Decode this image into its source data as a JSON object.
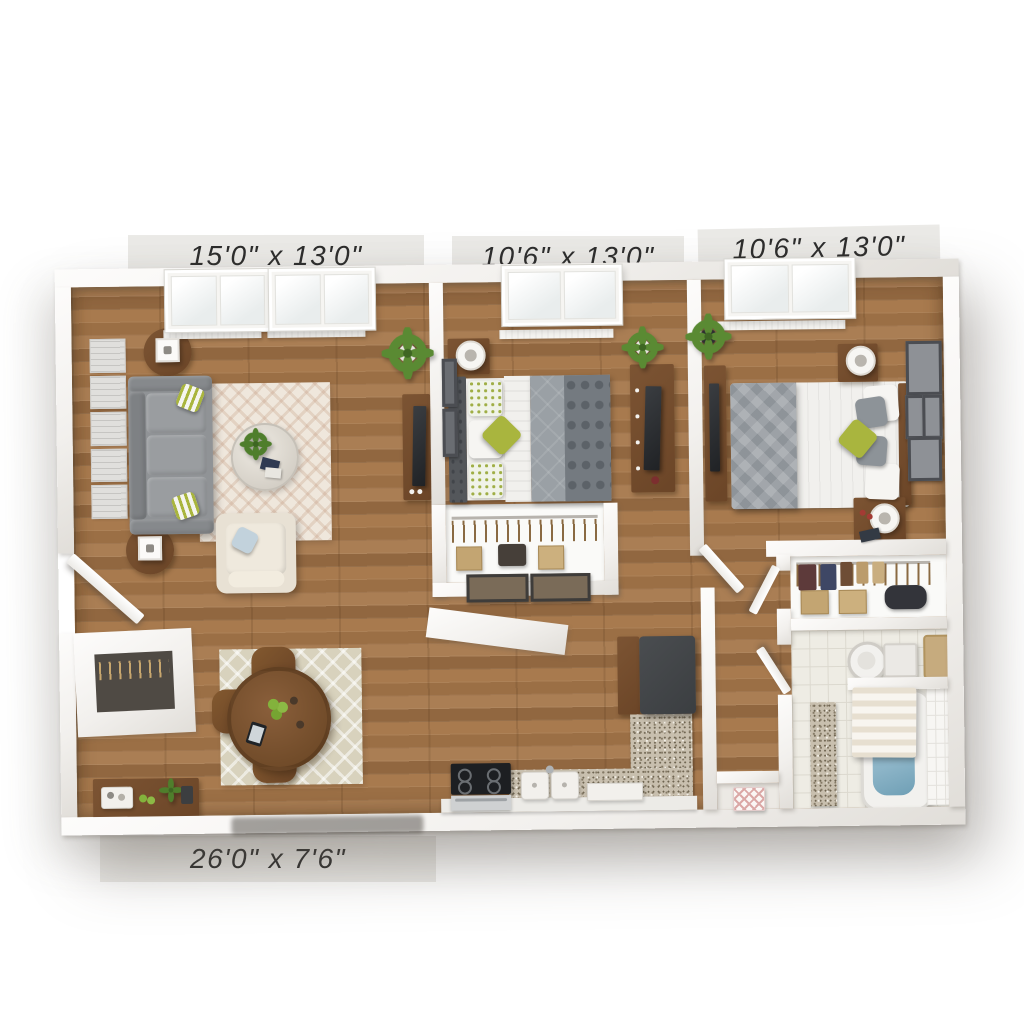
{
  "rooms": [
    {
      "name": "living-room",
      "dimensions": "15'0\" x 13'0\"",
      "furniture": [
        "sofa",
        "striped-accent-pillows",
        "round-side-tables",
        "cube-lamps",
        "wall-art-panels",
        "chevron-area-rug",
        "round-glass-coffee-table",
        "potted-plant",
        "tv-console",
        "tv",
        "armchair",
        "throw-pillow",
        "double-windows",
        "baseboard-heater"
      ]
    },
    {
      "name": "bedroom-one",
      "dimensions": "10'6\" x 13'0\"",
      "furniture": [
        "bed",
        "tufted-headboard",
        "floral-pillows",
        "green-accent-pillow",
        "gray-duvet",
        "patterned-throw",
        "nightstand",
        "basket-lamp",
        "potted-plant",
        "dresser",
        "tv",
        "reach-in-closet",
        "hanging-clothes",
        "storage-boxes",
        "framed-art",
        "window",
        "baseboard-heater"
      ]
    },
    {
      "name": "bedroom-two",
      "dimensions": "10'6\" x 13'0\"",
      "furniture": [
        "bed",
        "wood-headboard",
        "white-duvet",
        "diamond-pattern-blanket",
        "green-accent-pillow",
        "gray-pillows",
        "two-nightstands",
        "drum-lamps",
        "potted-plant",
        "dresser",
        "tv",
        "gallery-wall-frames",
        "window",
        "baseboard-heater"
      ]
    },
    {
      "name": "kitchen-dining",
      "dimensions": "26'0\" x 7'6\"",
      "furniture": [
        "round-dining-table",
        "four-dining-chairs",
        "fruit-bowl",
        "tablet",
        "trellis-rug",
        "console-table",
        "serving-tray",
        "half-wall",
        "range",
        "oven",
        "double-sink",
        "dishwasher",
        "refrigerator",
        "granite-countertop",
        "doormat"
      ]
    }
  ],
  "areas": [
    {
      "name": "bathroom",
      "furniture": [
        "toilet",
        "bathtub",
        "shower-curtain",
        "tile-floor",
        "tile-wall",
        "vanity-counter",
        "bath-mat"
      ]
    },
    {
      "name": "linen-closet",
      "furniture": [
        "hanging-clothes",
        "storage-boxes",
        "duffel-bag"
      ]
    },
    {
      "name": "hallway",
      "furniture": [
        "hall-closet",
        "patterned-storage-box",
        "interior-doors"
      ]
    },
    {
      "name": "entry",
      "furniture": [
        "entry-door",
        "entry-closet"
      ]
    }
  ],
  "colors": {
    "background": "#ffffff",
    "label_strip": "#ebeae7",
    "label_text": "#2d2d2d",
    "floor_a": "#a57a50",
    "accent_green": "#a9b53e",
    "plant_green": "#5a8a33",
    "sofa_gray": "#909396",
    "bed_gray": "#9aa0a5",
    "bed_dark": "#747a80",
    "rug_cream": "#efe7dc",
    "rug_beige": "#d8d2bd",
    "wood": "#7c5433",
    "tv_black": "#202225",
    "fridge_dark": "#3b3e41",
    "granite": "#c8bfae",
    "tile_floor": "#eeece4",
    "water_blue": "#8db5c8",
    "pillow_blue": "#c2d2dc"
  }
}
